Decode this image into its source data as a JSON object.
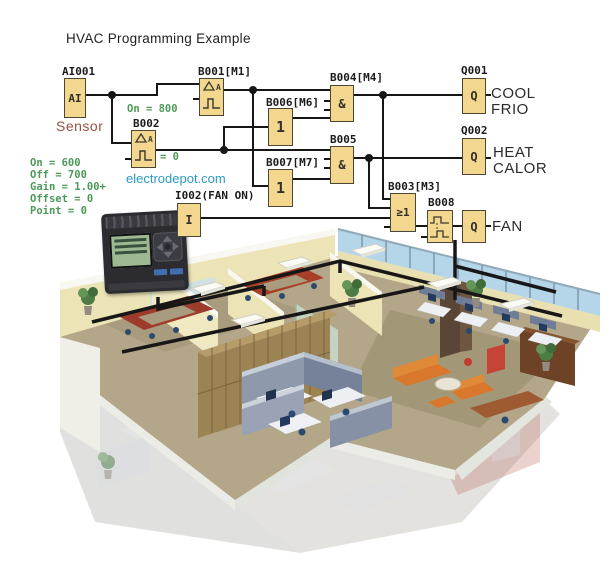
{
  "title": "HVAC Programming Example",
  "watermark": "electrodepot.com",
  "schematic": {
    "blocks": {
      "ai001": {
        "label": "AI001",
        "symbol": "AI",
        "caption": "Sensor"
      },
      "b001": {
        "label": "B001[M1]",
        "param": "On = 800"
      },
      "b002": {
        "label": "B002",
        "param": "= 0",
        "params": [
          "On = 600",
          "Off = 700",
          "Gain = 1.00+",
          "Offset = 0",
          "Point = 0"
        ]
      },
      "b006": {
        "label": "B006[M6]",
        "symbol": "1"
      },
      "b007": {
        "label": "B007[M7]",
        "symbol": "1"
      },
      "b004": {
        "label": "B004[M4]",
        "symbol": "&"
      },
      "b005": {
        "label": "B005",
        "symbol": "&"
      },
      "b003": {
        "label": "B003[M3]",
        "symbol": "≥1"
      },
      "b008": {
        "label": "B008"
      },
      "q001": {
        "label": "Q001",
        "symbol": "Q"
      },
      "q002": {
        "label": "Q002",
        "symbol": "Q"
      },
      "qfan": {
        "symbol": "Q"
      },
      "i002": {
        "label": "I002(FAN ON)",
        "symbol": "I"
      }
    },
    "outputs": {
      "cool_line1": "COOL",
      "cool_line2": "FRIO",
      "heat_line1": "HEAT",
      "heat_line2": "CALOR",
      "fan": "FAN"
    },
    "connections": [
      "AI001 -> B001, B002",
      "B001 -> B004, B007",
      "B002 -> B006, B005",
      "B006 -> B004",
      "B007 -> B005",
      "B004 -> Q001, B003",
      "B005 -> Q002, B003",
      "I002 -> B003",
      "B003 -> B008",
      "B008 -> FAN Q"
    ]
  },
  "palette": {
    "block_fill": "#f4d78e",
    "block_border": "#4b4636",
    "wire": "#161616",
    "param_green": "#4c9a58",
    "sensor_caption": "#9a4f44",
    "watermark_blue": "#2d9bc1",
    "building_wall": "#ece4b6",
    "building_floor": "#b3a689",
    "window_glass": "#b5d5e8",
    "cubicle_partition": "#8e99ac",
    "sofa_orange": "#d9782c",
    "wood_cabinet": "#9c8354",
    "duct_black": "#171717"
  },
  "illustration": {
    "type": "isometric-office-cutaway",
    "alt": "3D cutaway rendering of an office floor served by HVAC ductwork",
    "features": [
      "black HVAC duct runs on ceiling",
      "white ceiling AC cassettes",
      "cream perimeter walls",
      "blue glass window band",
      "gray office cubicles with desks",
      "conference rooms with dark red tables",
      "orange lounge sofas",
      "wood cabinet walls",
      "potted plants",
      "ghosted lower floor",
      "compact PLC controller photo with LCD and keypad"
    ]
  }
}
